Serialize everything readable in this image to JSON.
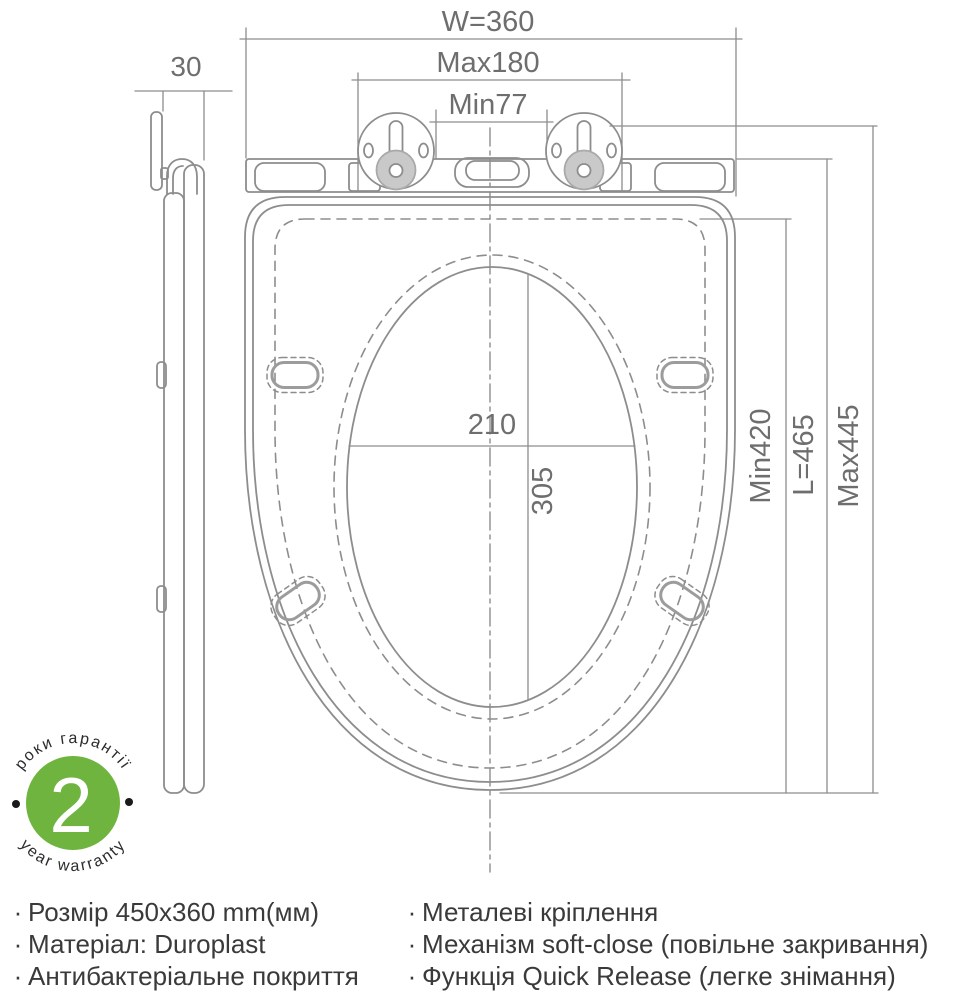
{
  "colors": {
    "line": "#8d8d8d",
    "dim_text": "#6e6e6e",
    "badge_green": "#6eb43e",
    "body_text": "#3a3a3a",
    "hinge_fill": "#c9c9c9"
  },
  "dimensions": {
    "side_thickness": "30",
    "width": "W=360",
    "hinge_span_max": "Max180",
    "hinge_span_min": "Min77",
    "opening_width": "210",
    "opening_length": "305",
    "length_min": "Min420",
    "length_total": "L=465",
    "length_max": "Max445"
  },
  "warranty": {
    "number": "2",
    "label_uk": "роки гарантії",
    "label_en": "year warranty"
  },
  "features": {
    "bullet": "·",
    "left": [
      "Розмір 450x360 mm(мм)",
      "Матеріал: Duroplast",
      "Антибактеріальне покриття"
    ],
    "right": [
      "Металеві кріплення",
      "Механізм soft-close (повільне закривання)",
      "Функція Quick Release (легке знімання)"
    ]
  }
}
